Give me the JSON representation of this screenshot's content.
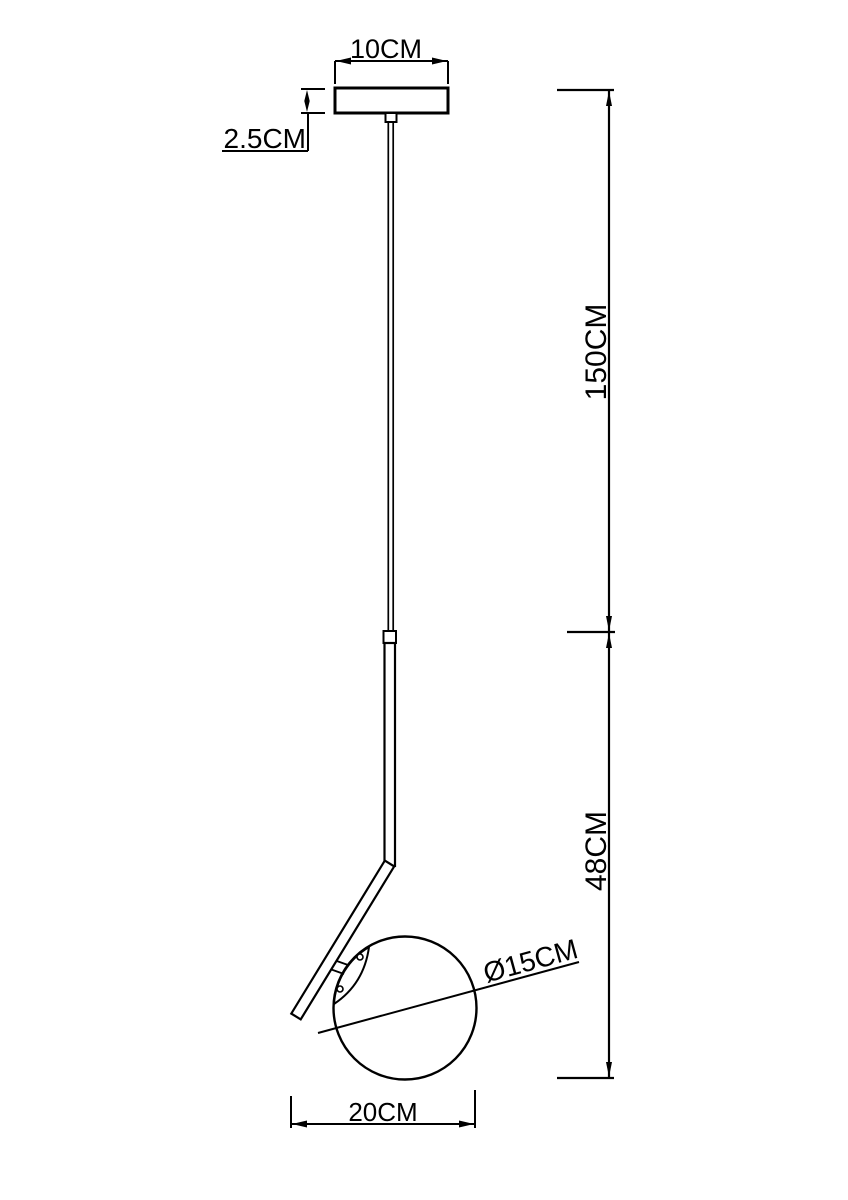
{
  "drawing": {
    "background": "#ffffff",
    "line_color": "#000000",
    "labels": {
      "canopy_width": "10CM",
      "canopy_height": "2.5CM",
      "suspension_length": "150CM",
      "body_height": "48CM",
      "globe_diameter": "Ø15CM",
      "overall_width": "20CM"
    }
  }
}
